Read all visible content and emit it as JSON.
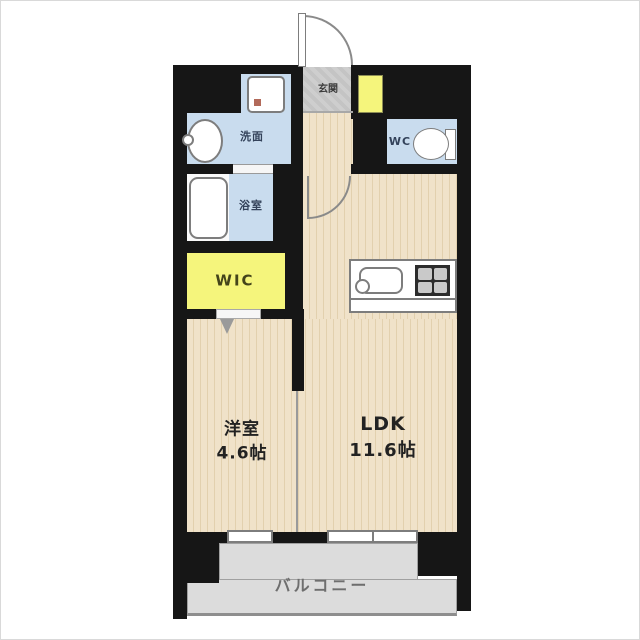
{
  "floorplan": {
    "title": "1LDK apartment floor plan",
    "rooms": {
      "entrance": {
        "label": "玄関"
      },
      "washroom": {
        "label": "洗面"
      },
      "toilet": {
        "label": "WC"
      },
      "bathroom": {
        "label": "浴室"
      },
      "walk_in_closet": {
        "label": "WIC"
      },
      "western_room": {
        "label": "洋室",
        "size": "4.6帖"
      },
      "ldk": {
        "label": "LDK",
        "size": "11.6帖"
      },
      "balcony": {
        "label": "バルコニー"
      }
    },
    "colors": {
      "wall": "#161616",
      "wood": "#f0e2c9",
      "wet": "#c9dcee",
      "yellow": "#f5f57c",
      "tile": "#c4c4c4",
      "balcony": "#dcdcdc"
    }
  }
}
